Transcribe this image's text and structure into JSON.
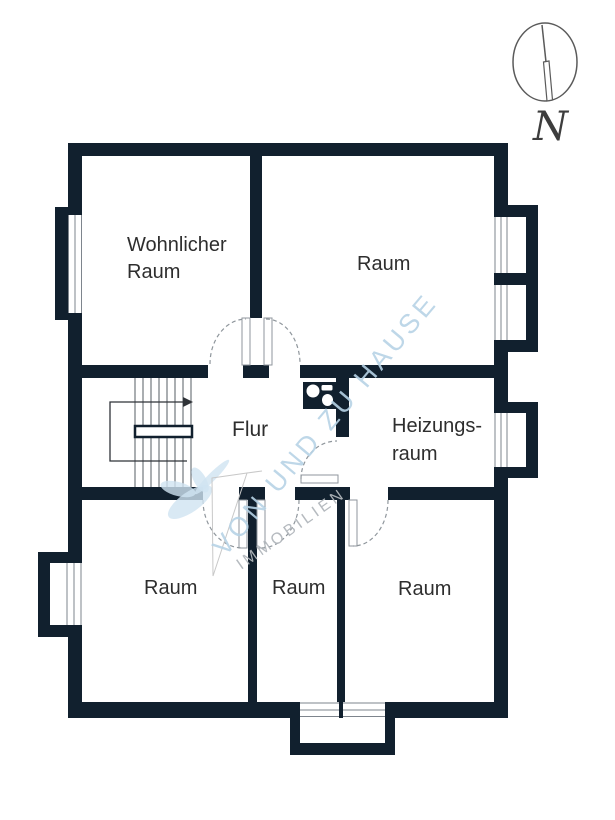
{
  "floorplan": {
    "rooms": {
      "wohnlicher": {
        "line1": "Wohnlicher",
        "line2": "Raum"
      },
      "top_right": {
        "label": "Raum"
      },
      "flur": {
        "label": "Flur"
      },
      "heizung": {
        "line1": "Heizungs-",
        "line2": "raum"
      },
      "bottom_left": {
        "label": "Raum"
      },
      "bottom_middle": {
        "label": "Raum"
      },
      "bottom_right": {
        "label": "Raum"
      }
    },
    "compass": {
      "label": "N"
    },
    "watermark": {
      "line1": "VON UND ZU HAUSE",
      "line2": "IMMOBILIEN"
    },
    "colors": {
      "wall": "#11202e",
      "label": "#2e2e2e",
      "wmblue": "#b7d3e6",
      "wmgray": "#b2b7bc",
      "line": "#8f969c"
    }
  }
}
